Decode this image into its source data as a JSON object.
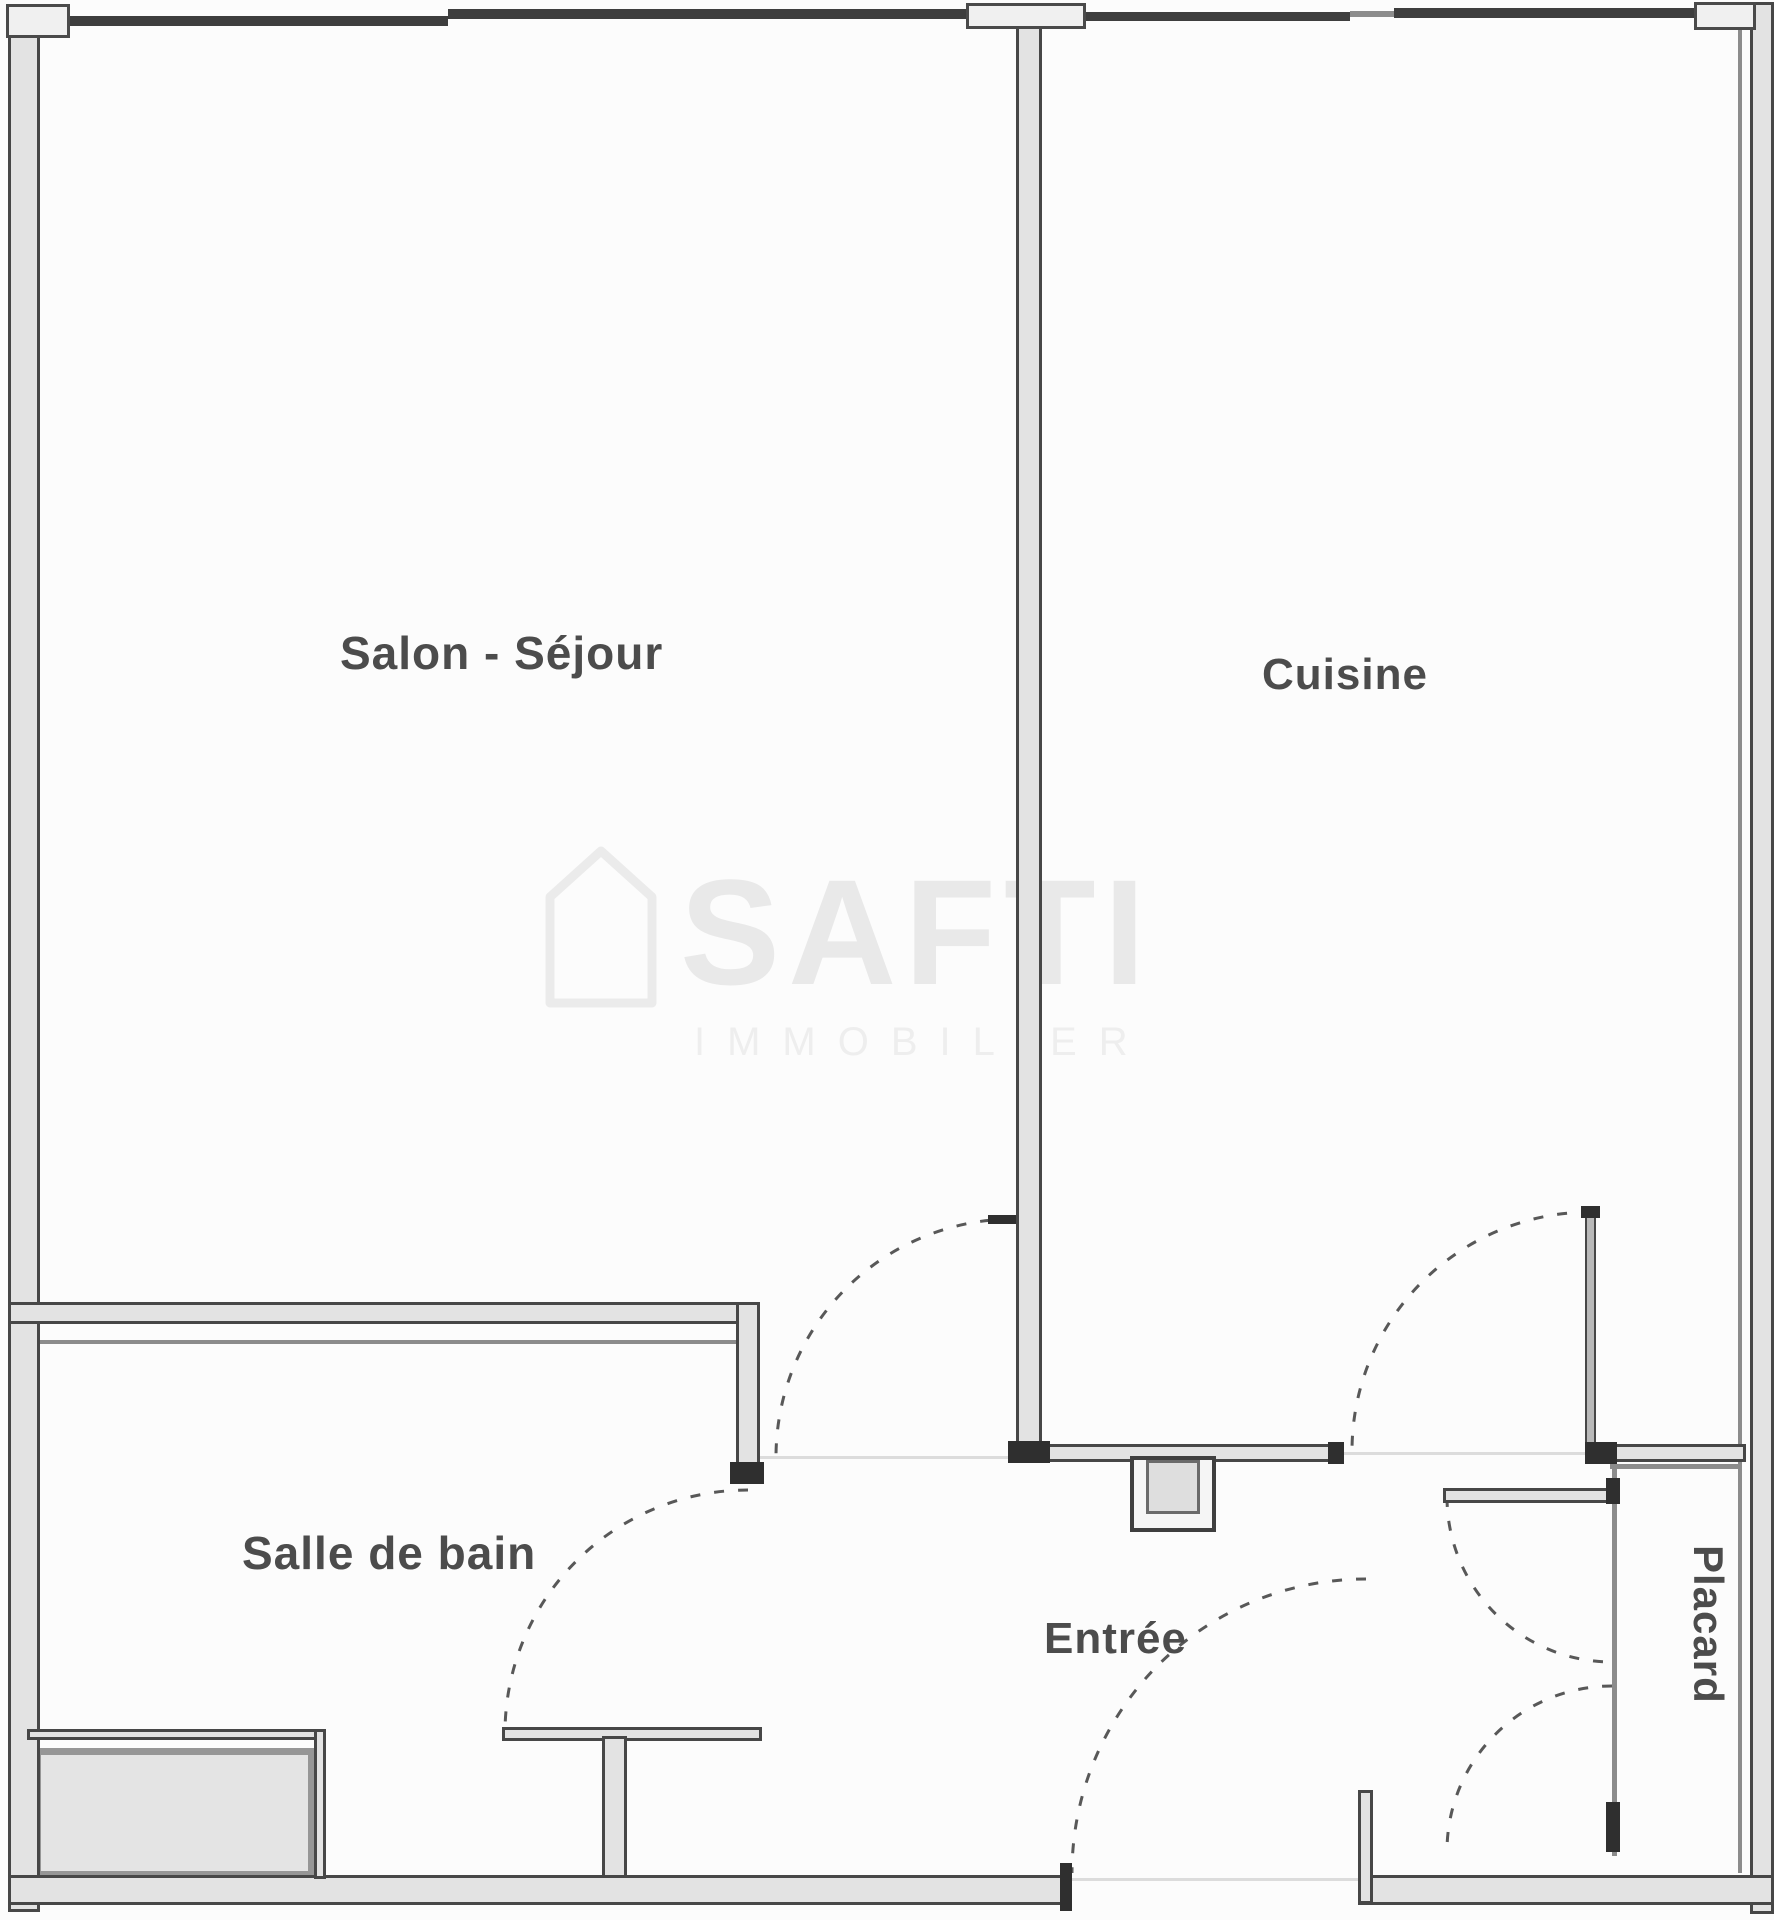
{
  "rooms": {
    "living": "Salon - Séjour",
    "kitchen": "Cuisine",
    "bathroom": "Salle de bain",
    "entry": "Entrée",
    "closet": "Placard"
  },
  "watermark": {
    "brand": "SAFTI",
    "subtitle": "IMMOBILIER"
  },
  "colors": {
    "wall_line": "#474747",
    "wall_fill": "#e3e3e3",
    "wall_cap": "#2f2f2f",
    "thin_line": "#8c8c8c",
    "label_text": "#4c4c4c",
    "door_dash": "#585858",
    "watermark": "#e9e9e9",
    "background": "#fcfcfc",
    "shaded_fill": "#e4e4e4"
  }
}
